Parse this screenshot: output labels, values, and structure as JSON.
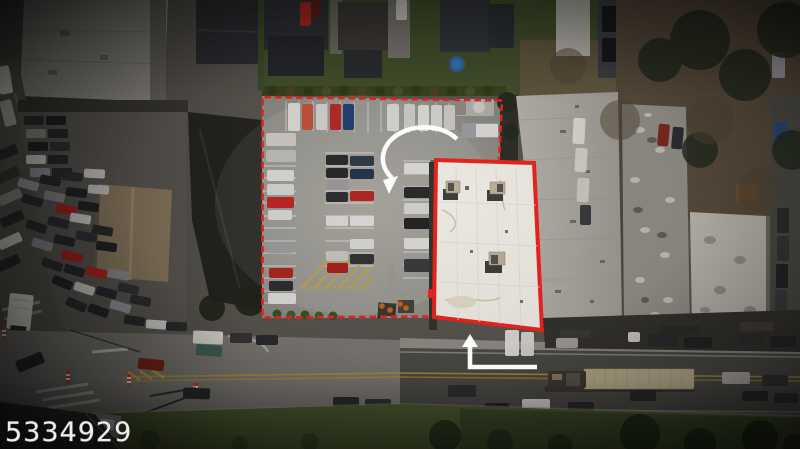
{
  "description": "Aerial drone photograph of a commercial property: a parking lot full of cars outlined with a red dashed parcel boundary, a flat white-roofed building highlighted with a solid red outline, a curved white arrow over the lot and a white L-shaped arrow pointing up at the building from the main road, surrounded by residential houses, neighboring flat roofs, a car dealership lot and street traffic.",
  "watermark": {
    "text": "5334929"
  },
  "annotations": {
    "parcel_boundary": {
      "style": "dashed",
      "color": "#e8231e"
    },
    "building_highlight": {
      "style": "solid",
      "color": "#e8231e"
    },
    "curved_arrow": {
      "color": "#ffffff"
    },
    "l_shaped_arrow": {
      "color": "#ffffff"
    }
  },
  "colors": {
    "annotation_red": "#e8231e",
    "arrow_white": "#ffffff",
    "lot_asphalt": "#92908a",
    "subject_roof": "#ebe8e1",
    "road_asphalt": "#4b4945",
    "grass": "#4d5a30"
  }
}
